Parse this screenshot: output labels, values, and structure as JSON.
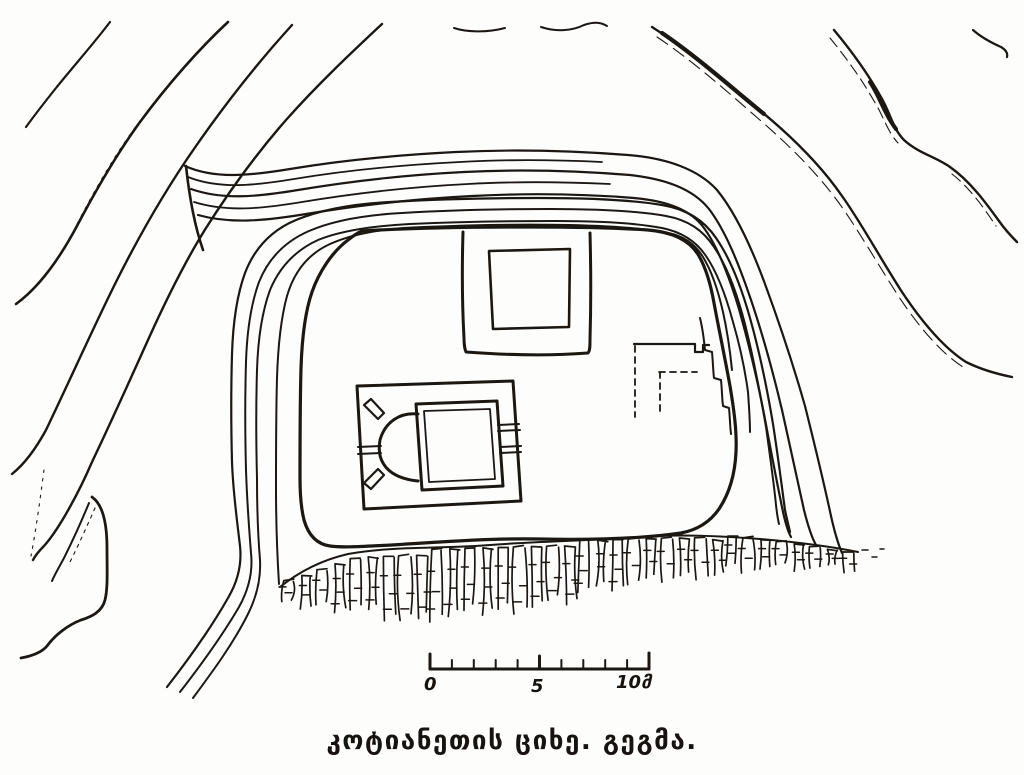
{
  "figure": {
    "caption": "კოტიანეთის ციხე. გეგმა.",
    "scale_bar": {
      "label_0": "0",
      "label_5": "5",
      "label_10": "10მ",
      "tick_count": 11
    },
    "colors": {
      "ink": "#1b1713",
      "paper": "#fdfdfc"
    },
    "cliff_band": {
      "x_start": 290,
      "x_end": 854,
      "column_step": 16.4
    },
    "features": [
      "terrain-contour-lines-northwest",
      "terrain-contour-lines-northeast",
      "rampart-terrace-lines",
      "main-curtain-wall",
      "corner-tower-with-inner-chamber",
      "church-with-apse-in-walled-enclosure",
      "ruined-building-dashed-outline",
      "cliff-rock-escarpment",
      "access-road-southwest",
      "rock-spur-southwest",
      "scale-bar-meters"
    ]
  }
}
